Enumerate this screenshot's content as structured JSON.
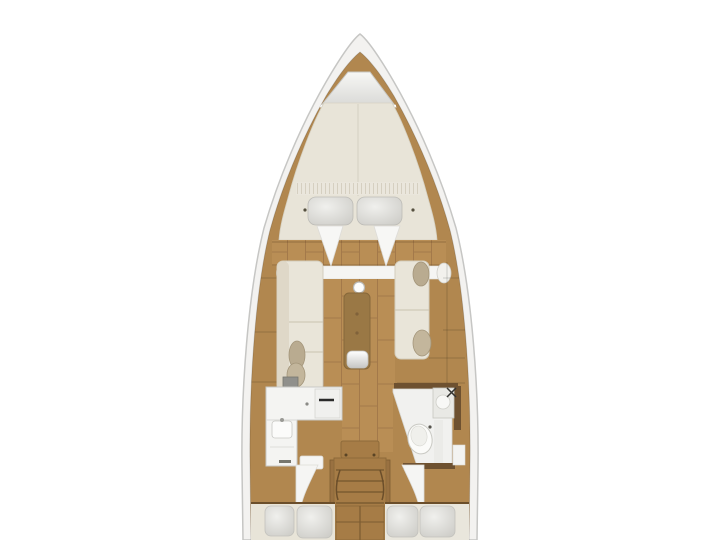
{
  "colors": {
    "background": "#ffffff",
    "hull": "#f3f2f0",
    "hull_outline": "#c6c6c4",
    "wood": "#b1874f",
    "wood_floor": "#b98e55",
    "wood_dark": "#6e5130",
    "table_wood": "#9a7845",
    "steps_wood": "#a67c46",
    "steps_edge": "#8d6a3a",
    "mattress": "#e8e4d8",
    "cushion": "#e9e5d9",
    "cushion_edge": "#d3cdbd",
    "pillow": "#d9d8d3",
    "throw_pillow": "#b9ab90",
    "fixture_white": "#f4f4f2",
    "fixture_edge": "#cfcfca",
    "locker": "#e9e9e7",
    "white_panel": "#f5f5f3"
  },
  "regions": [
    "anchor-locker",
    "forward-cabin-v-berth",
    "saloon",
    "galley",
    "head-bathroom",
    "companionway-steps",
    "aft-cabin-port",
    "aft-cabin-starboard"
  ],
  "fixtures": {
    "forward_pillows": 2,
    "aft_pillows_per_cabin": 2,
    "saloon_table": 1,
    "mast_post": 1,
    "galley_sink": 1,
    "galley_stove": 1,
    "head_toilet": 1,
    "head_sink": 1
  }
}
